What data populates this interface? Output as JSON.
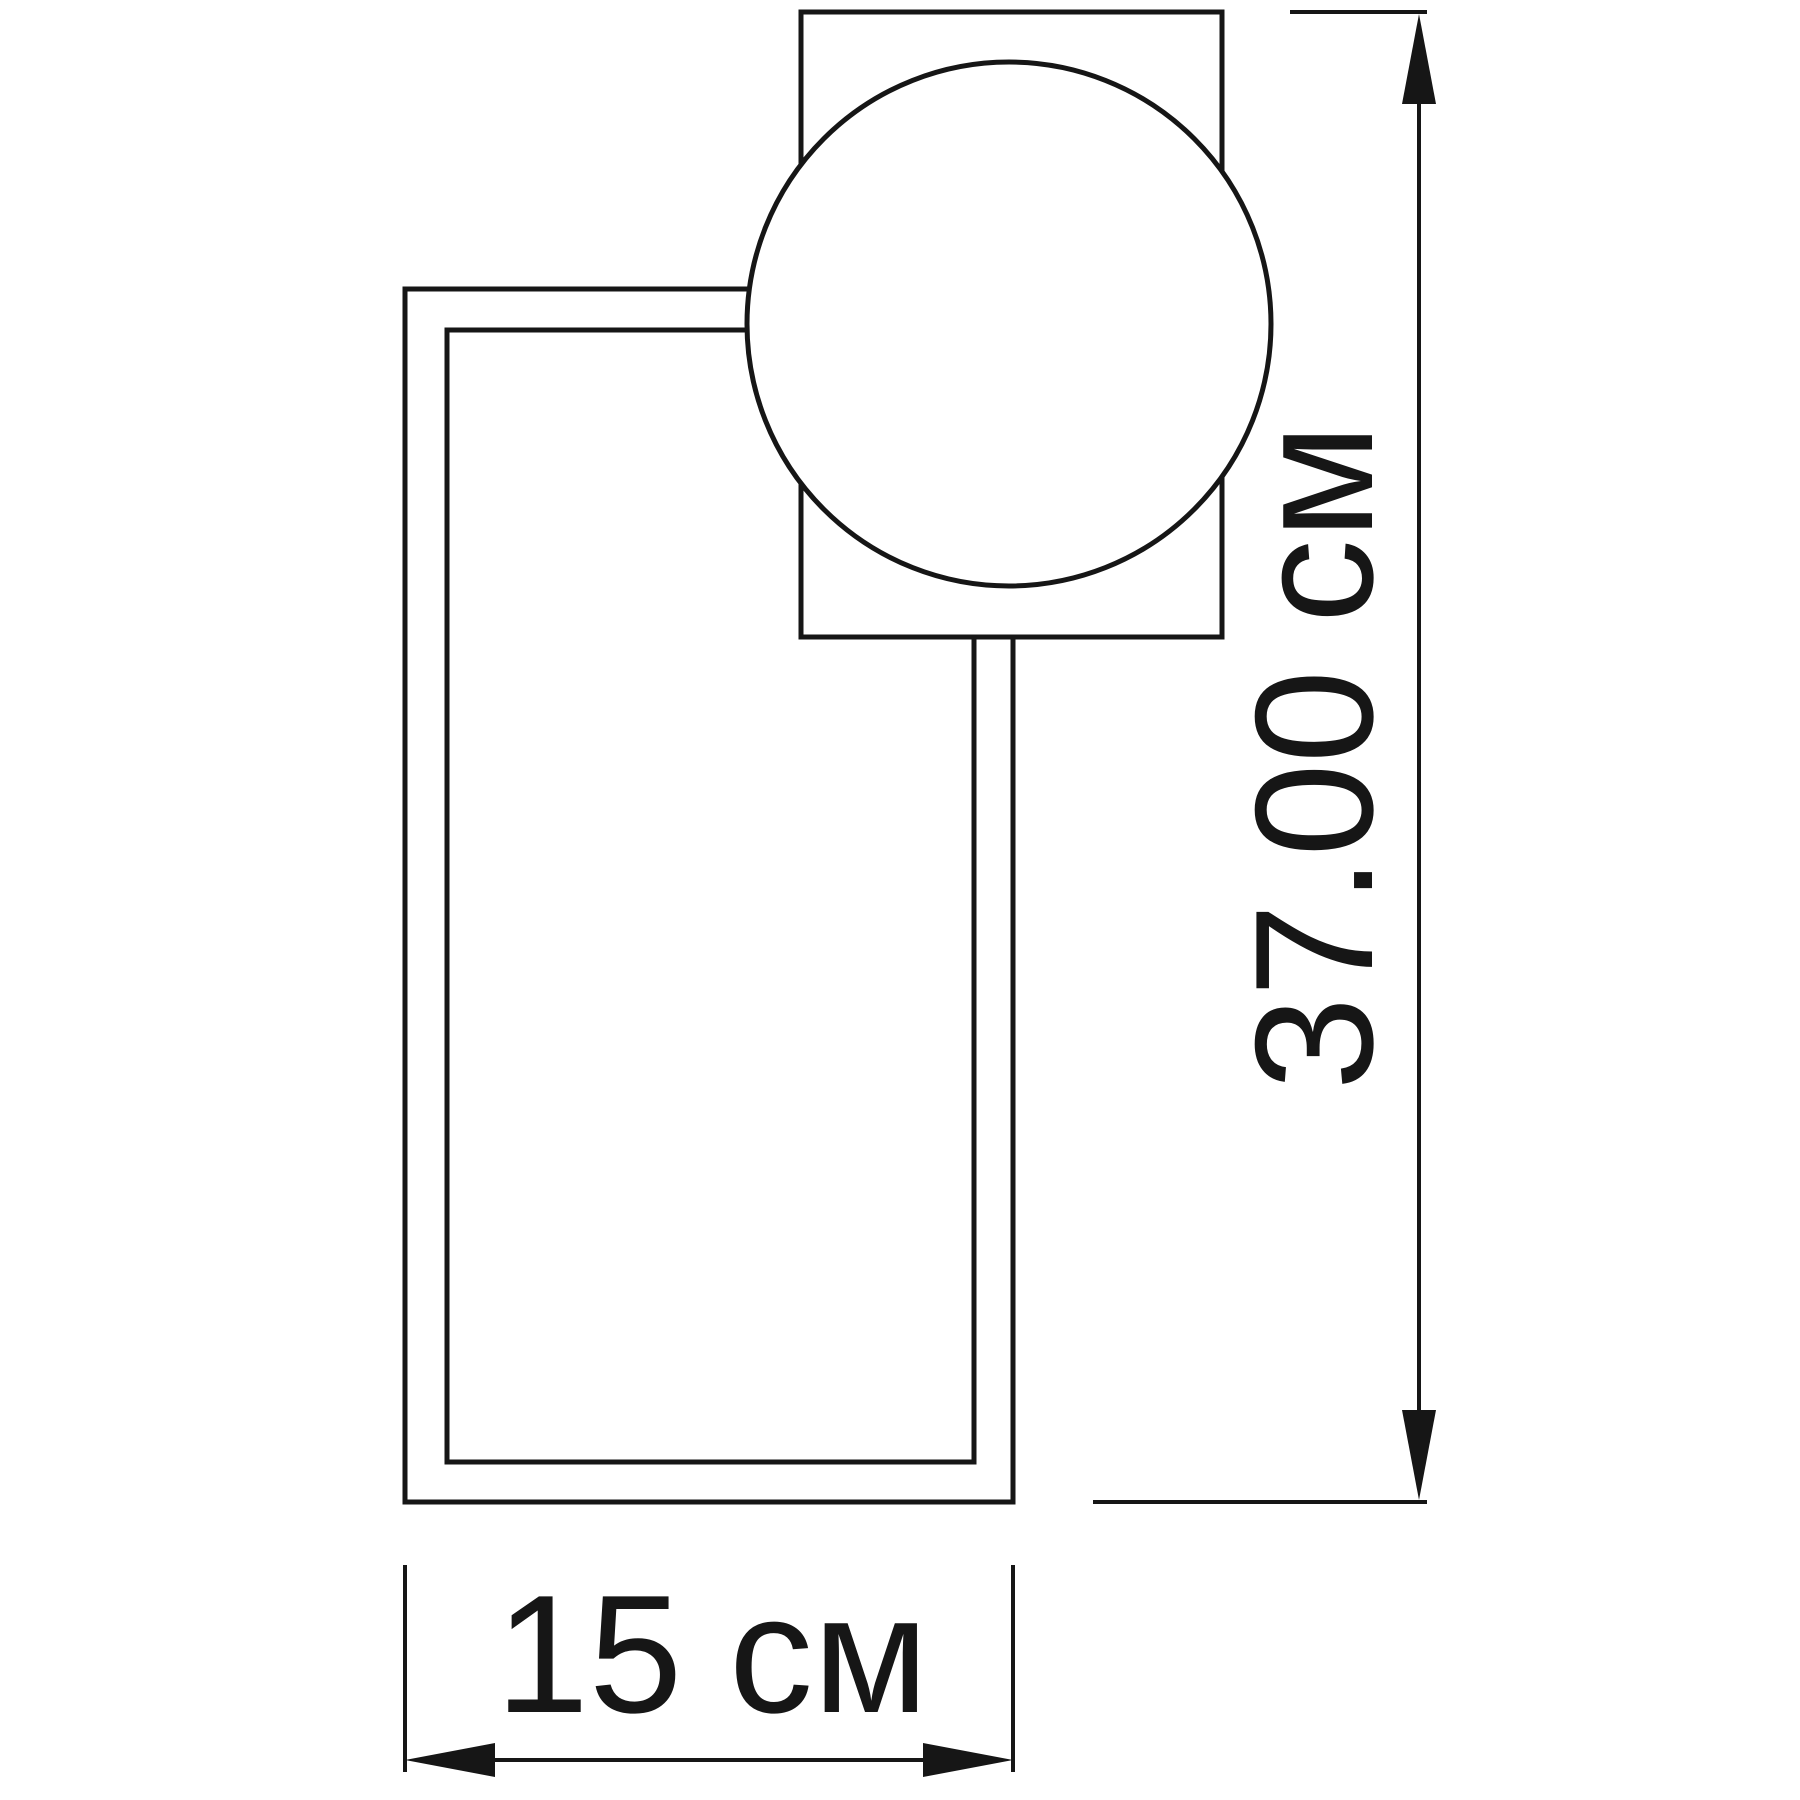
{
  "colors": {
    "background": "#ffffff",
    "line": "#161616"
  },
  "drawing": {
    "type": "dimensional technical drawing of a wall lamp (rectangular frame with globe shade)",
    "height_dimension": {
      "label": "37.00 см",
      "value": "37.00",
      "unit": "см"
    },
    "width_dimension": {
      "label": "15 см",
      "value": "15",
      "unit": "см"
    }
  }
}
